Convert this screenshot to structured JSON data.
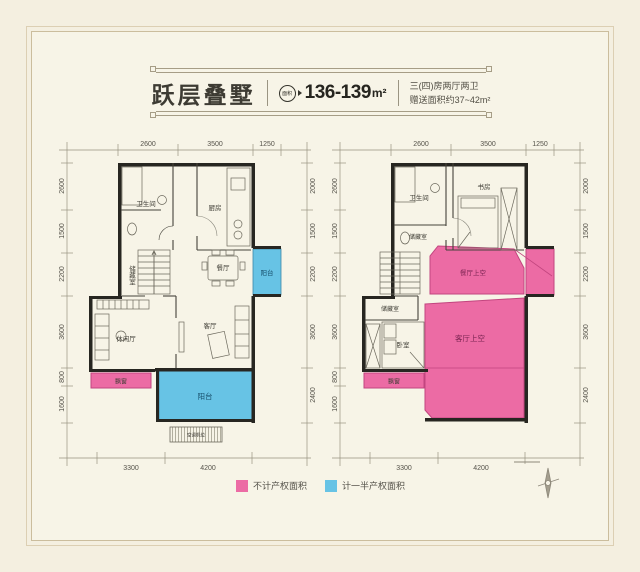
{
  "header": {
    "title": "跃层叠墅",
    "badge_label": "面积",
    "area_value": "136-139",
    "area_unit": "m²",
    "desc_line1": "三(四)房两厅两卫",
    "desc_line2": "赠送面积约37~42m²"
  },
  "colors": {
    "pink": "#ec6ba4",
    "blue": "#67c3e5",
    "wall": "#272621",
    "background": "#f7f4e7"
  },
  "floor1": {
    "dims_top": [
      "2600",
      "3500",
      "1250"
    ],
    "dims_left": [
      "2600",
      "1500",
      "2200",
      "3600",
      "800",
      "1600"
    ],
    "dims_right": [
      "2000",
      "1500",
      "2200",
      "3600",
      "2400"
    ],
    "dims_bottom": [
      "3300",
      "4200"
    ],
    "rooms": {
      "bathroom": "卫生间",
      "kitchen": "厨房",
      "storage": "储藏室",
      "dining": "餐厅",
      "side_balcony": "阳台",
      "leisure": "休闲厅",
      "living": "客厅",
      "bay_window": "飘窗",
      "main_balcony": "阳台",
      "ac_pad": "空调机位"
    }
  },
  "floor2": {
    "dims_top": [
      "2600",
      "3500",
      "1250"
    ],
    "dims_left": [
      "2600",
      "1500",
      "2200",
      "3600",
      "800",
      "1600"
    ],
    "dims_right": [
      "2000",
      "1500",
      "2200",
      "3600",
      "2400"
    ],
    "dims_bottom": [
      "3300",
      "4200"
    ],
    "rooms": {
      "bathroom": "卫生间",
      "storage_upper": "储藏室",
      "study": "书房",
      "storage_lower": "储藏室",
      "bedroom": "卧室",
      "bay_window": "飘窗",
      "dining_void": "餐厅上空",
      "living_void": "客厅上空"
    }
  },
  "legend": {
    "items": [
      {
        "label": "不计产权面积"
      },
      {
        "label": "计一半产权面积"
      }
    ]
  }
}
